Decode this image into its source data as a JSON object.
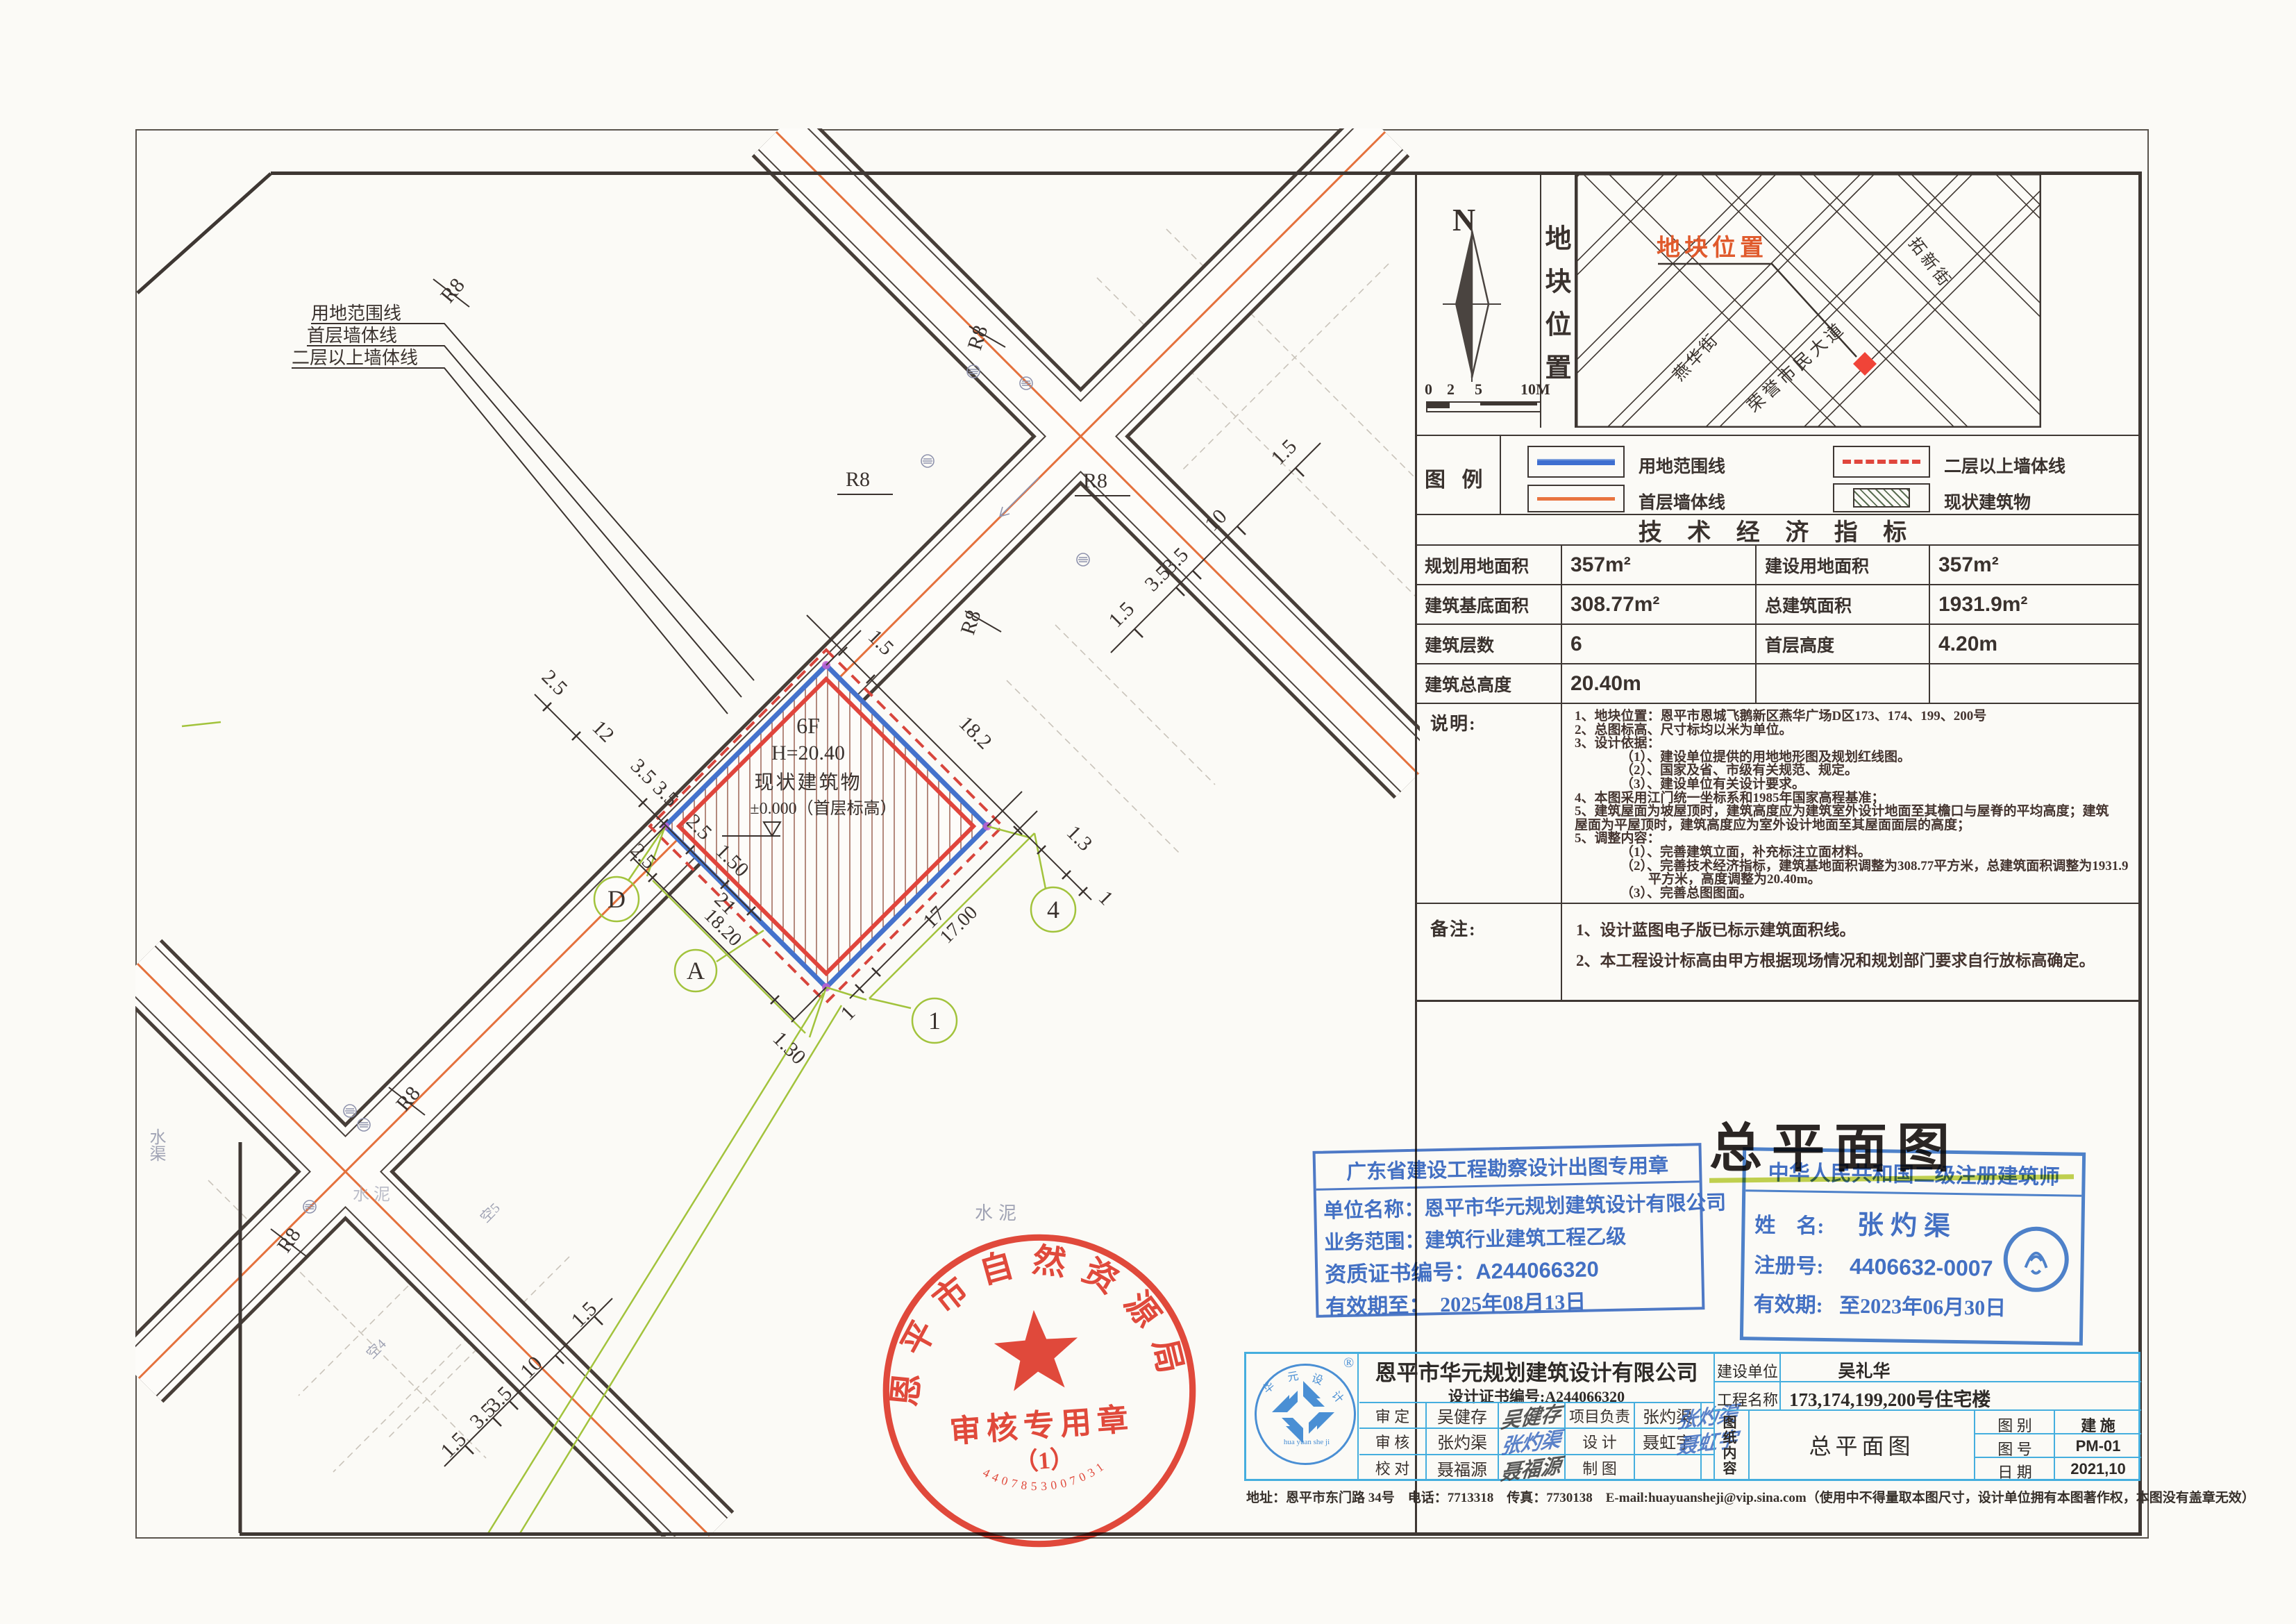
{
  "sheet": {
    "plan_title": "总平面图",
    "footer": "地址：恩平市东门路 34号　电话：7713318　传真：7730138　E-mail:huayuansheji@vip.sina.com（使用中不得量取本图尺寸，设计单位拥有本图著作权，本图没有盖章无效）"
  },
  "north": {
    "label": "N",
    "scale_ticks": [
      "0",
      "2",
      "5",
      "10M"
    ]
  },
  "location": {
    "panel_title": "地块位置",
    "map_label": "地块位置",
    "street_tuoxin": "拓新街",
    "street_rongyu": "荣誉市民大道",
    "street_yanhua": "燕华街"
  },
  "legend": {
    "title": "图 例",
    "item_boundary": "用地范围线",
    "item_first": "首层墙体线",
    "item_upper": "二层以上墙体线",
    "item_existing": "现状建筑物"
  },
  "indicators": {
    "title": "技 术 经 济 指 标",
    "rows": [
      {
        "l1": "规划用地面积",
        "v1": "357m²",
        "l2": "建设用地面积",
        "v2": "357m²"
      },
      {
        "l1": "建筑基底面积",
        "v1": "308.77m²",
        "l2": "总建筑面积",
        "v2": "1931.9m²"
      },
      {
        "l1": "建筑层数",
        "v1": "6",
        "l2": "首层高度",
        "v2": "4.20m"
      },
      {
        "l1": "建筑总高度",
        "v1": "20.40m",
        "l2": "",
        "v2": ""
      }
    ]
  },
  "notes": {
    "label": "说明:",
    "lines": [
      "1、地块位置：恩平市恩城飞鹅新区燕华广场D区173、174、199、200号",
      "2、总图标高、尺寸标均以米为单位。",
      "3、设计依据：",
      "（1）、建设单位提供的用地地形图及规划红线图。",
      "（2）、国家及省、市级有关规范、规定。",
      "（3）、建设单位有关设计要求。",
      "4、本图采用江门统一坐标系和1985年国家高程基准；",
      "5、建筑屋面为坡屋顶时，建筑高度应为建筑室外设计地面至其檐口与屋脊的平均高度；建筑",
      "屋面为平屋顶时，建筑高度应为室外设计地面至其屋面面层的高度；",
      "5、调整内容：",
      "（1）、完善建筑立面，补充标注立面材料。",
      "（2）、完善技术经济指标，建筑基地面积调整为308.77平方米，总建筑面积调整为1931.9",
      "平方米，高度调整为20.40m。",
      "（3）、完善总图图面。"
    ]
  },
  "remarks": {
    "label": "备注:",
    "lines": [
      "1、设计蓝图电子版已标示建筑面积线。",
      "2、本工程设计标高由甲方根据现场情况和规划部门要求自行放标高确定。"
    ]
  },
  "stamps": {
    "red": {
      "arc": "恩平市自然资源局",
      "title": "审核专用章",
      "number": "（1）",
      "serial": "4407853007031"
    },
    "blue_left": {
      "header": "广东省建设工程勘察设计出图专用章",
      "line_name": "单位名称：恩平市华元规划建筑设计有限公司",
      "line_scope": "业务范围：建筑行业建筑工程乙级",
      "line_cert": "资质证书编号：A244066320",
      "line_valid": "有效期至：　2025年08月13日"
    },
    "blue_right": {
      "header": "中华人民共和国二级注册建筑师",
      "name_label": "姓　名:",
      "name": "张灼渠",
      "reg_label": "注册号:",
      "reg": "4406632-0007",
      "valid_label": "有效期:",
      "valid": "至2023年06月30日"
    }
  },
  "titleblock": {
    "company": "恩平市华元规划建筑设计有限公司",
    "cert": "设计证书编号:A244066320",
    "logo": {
      "c1": "华",
      "c2": "元",
      "c3": "设",
      "c4": "计",
      "latin": "hua yuan she ji",
      "r": "®"
    },
    "rows_left": [
      {
        "role": "审 定",
        "name": "吴健存",
        "sig": "吴健存"
      },
      {
        "role": "审 核",
        "name": "张灼渠",
        "sig": "张灼渠"
      },
      {
        "role": "校 对",
        "name": "聂福源",
        "sig": "聂福源"
      }
    ],
    "rows_mid": [
      {
        "role": "项目负责",
        "name": "张灼渠",
        "sig": "张灼渠"
      },
      {
        "role": "设 计",
        "name": "聂虹宇",
        "sig": "聂虹宇"
      },
      {
        "role": "制 图",
        "name": "",
        "sig": ""
      }
    ],
    "client_label": "建设单位",
    "client": "吴礼华",
    "project_label": "工程名称",
    "project": "173,174,199,200号住宅楼",
    "content_label": "图纸内容",
    "content": "总平面图",
    "meta": [
      {
        "k": "图 别",
        "v": "建 施"
      },
      {
        "k": "图 号",
        "v": "PM-01"
      },
      {
        "k": "日 期",
        "v": "2021,10"
      }
    ]
  },
  "drawing": {
    "r8": "R8",
    "bubbles": {
      "d": "D",
      "a": "A",
      "n1": "1",
      "n4": "4"
    },
    "leaders": {
      "yongdi": "用地范围线",
      "shouceng": "首层墙体线",
      "erceng": "二层以上墙体线"
    },
    "building": {
      "floors": "6F",
      "height": "H=20.40",
      "name": "现状建筑物",
      "level": "±0.000（首层标高）"
    },
    "water": {
      "qu": "水渠",
      "ni": "水泥"
    },
    "parcels": {
      "k5": "空5",
      "k4": "空4"
    },
    "dims": {
      "a15": "1.5",
      "a182": "18.2",
      "a13": "1.3",
      "a1": "1",
      "b17": "17",
      "b1700": "17.00",
      "b1": "1",
      "c21": "21",
      "c1820": "18.20",
      "c130": "1.30",
      "c25": "2.5",
      "d25": "2.5",
      "d12": "12",
      "d35a": "3.5",
      "d35b": "3.5",
      "d25b": "2.5",
      "d150": "1.50",
      "e15a": "1.5",
      "e35a": "3.5",
      "e35b": "3.5",
      "e10": "10",
      "e15b": "1.5",
      "f15a": "1.5",
      "f35a": "3.5",
      "f35b": "3.5",
      "f10": "10",
      "f15b": "1.5"
    }
  }
}
